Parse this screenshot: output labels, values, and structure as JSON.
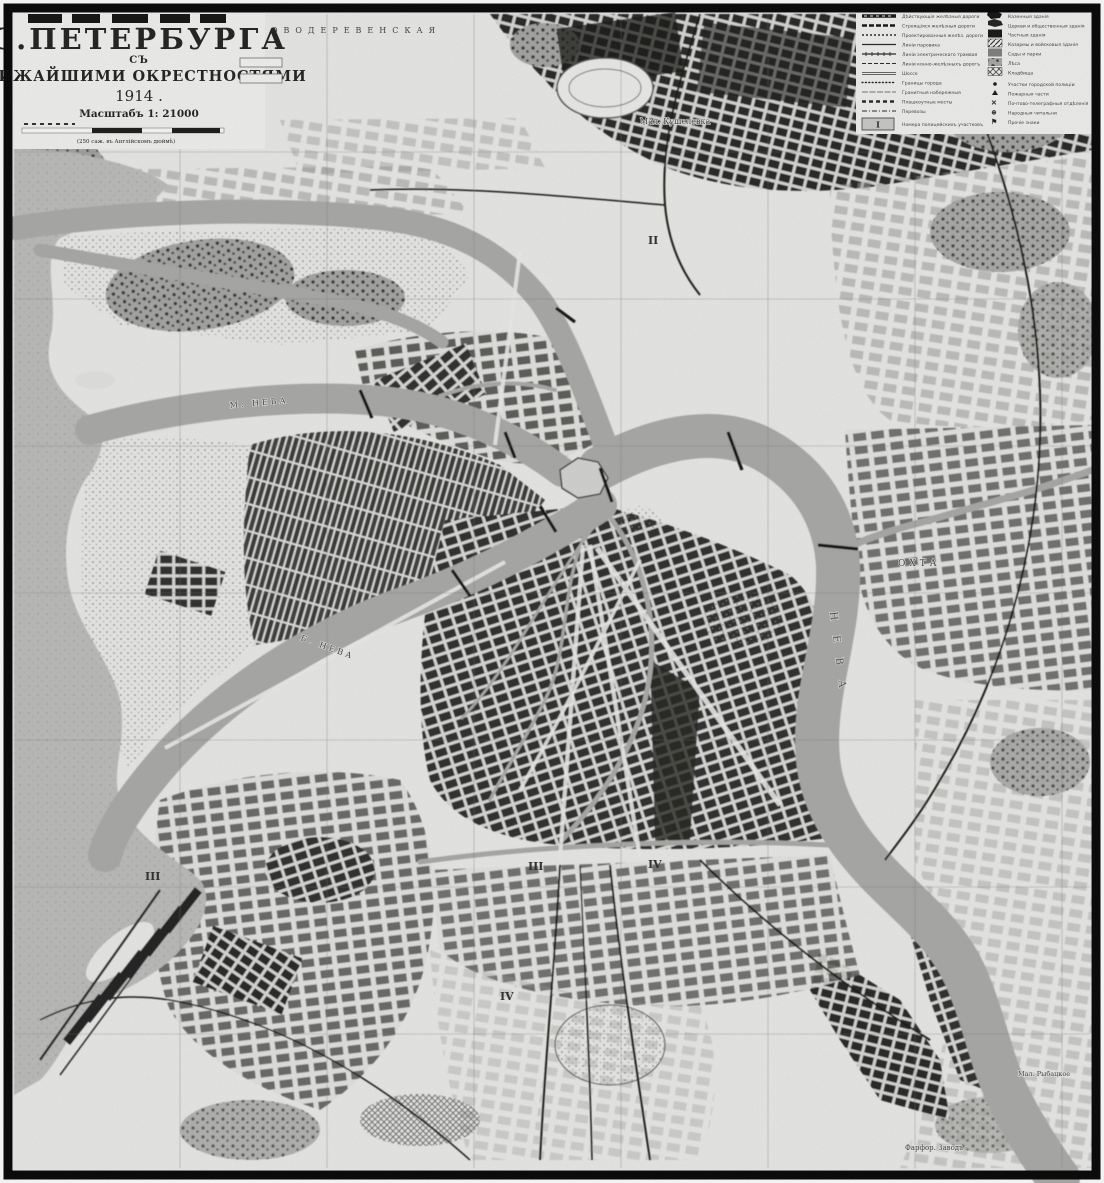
{
  "map": {
    "title": "С.ПЕТЕРБУРГА",
    "subtitle_prefix": "СЪ",
    "subtitle": "БЛИЖАЙШИМИ ОКРЕСТНОСТЯМИ",
    "year": "1914 .",
    "scale_label": "Масштабъ 1: 21000",
    "scale_note": "(250 саж. въ Англійскомъ дюймѣ)"
  },
  "legend": {
    "left": [
      {
        "label": "Дѣйствующія желѣзныя дороги"
      },
      {
        "label": "Строящіяся желѣзныя дороги"
      },
      {
        "label": "Проектированныя желѣз. дороги"
      },
      {
        "label": "Линіи паровика"
      },
      {
        "label": "Линіи электрическаго трамвая"
      },
      {
        "label": "Линіи конно-желѣзныхъ дорогъ"
      },
      {
        "label": "Шоссе"
      },
      {
        "label": "Границы города"
      },
      {
        "label": "Гранитныя набережныя"
      },
      {
        "label": "Плашкоутные мосты"
      },
      {
        "label": "Перевозы"
      }
    ],
    "left_footer": {
      "symbol": "I",
      "label": "Номера полицейскихъ участковъ"
    },
    "right_areas": [
      {
        "label": "Казенныя зданія"
      },
      {
        "label": "Церкви и общественныя зданія"
      },
      {
        "label": "Частныя зданія"
      },
      {
        "label": "Казармы и войсковыя зданія"
      },
      {
        "label": "Сады и парки"
      },
      {
        "label": "Лѣса"
      },
      {
        "label": "Кладбища"
      }
    ],
    "right_points": [
      {
        "label": "Участки городской полиціи"
      },
      {
        "label": "Пожарныя части"
      },
      {
        "label": "Почтово-телеграфныя отдѣленія"
      },
      {
        "label": "Народныя читальни"
      },
      {
        "label": "Прочіе знаки"
      }
    ]
  },
  "labels": {
    "novaya_derevnya": "НОВОДЕРЕВЕНСКАЯ",
    "kushelevka": "Мал. Кушелевка",
    "okhta": "ОХТА",
    "neva": "Н Е В А",
    "b_neva": "Б. НЕВА",
    "m_neva": "М. НЕВА",
    "farfor": "Фарфор. Заводъ",
    "rybatskoe": "Мал. Рыбацкое",
    "districts": [
      "II",
      "III",
      "IV",
      "III",
      "IV"
    ]
  },
  "colors": {
    "paper": "#ebebe9",
    "water": "#a9a9a7",
    "ink": "#1c1c1a",
    "block_dark": "#2b2b29",
    "frame": "#0b0b0b"
  }
}
